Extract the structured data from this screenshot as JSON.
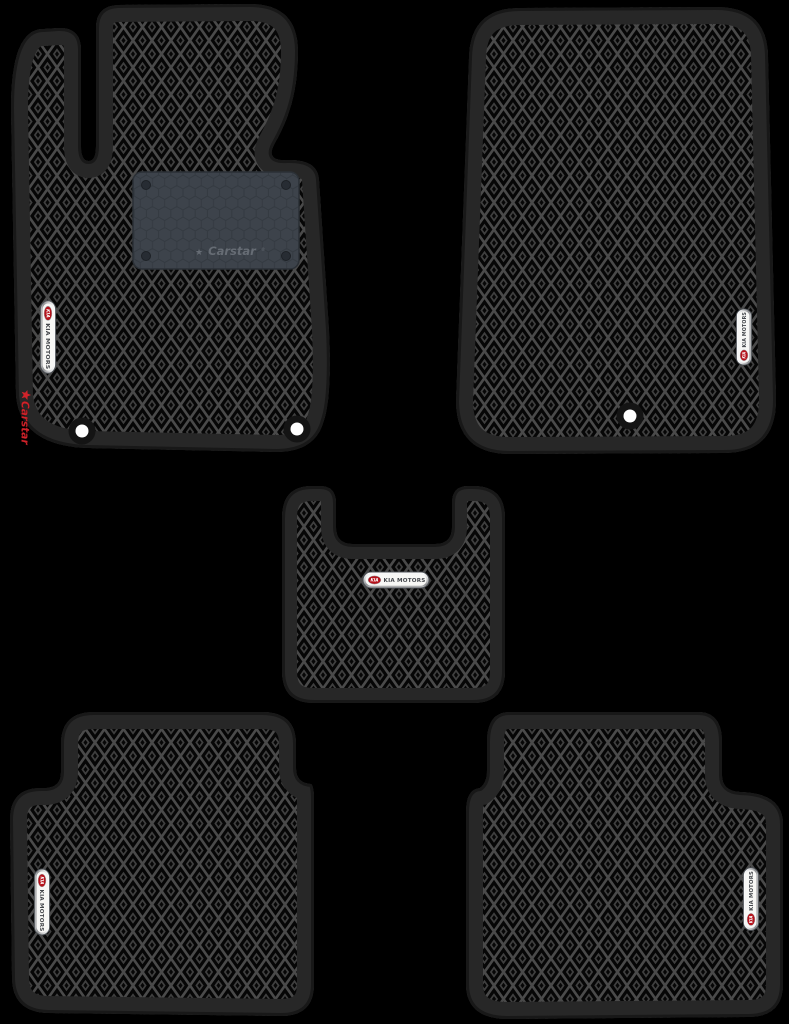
{
  "scene": {
    "background_color": "#000000"
  },
  "colors": {
    "mat_border": "#272727",
    "mat_edge_rim": "#181818",
    "pattern_grid": "#4a4a4a",
    "pattern_cell": "#060606",
    "pattern_ornament": "#3f3f3f",
    "heel_pad_fill": "#3d434b",
    "heel_pad_line": "#343a41",
    "badge_face": "#f7f7f5",
    "kia_red": "#b5121b",
    "badge_text": "#43464b",
    "carstar_red": "#d2232a",
    "heel_text_gray": "#666c74",
    "hole_white": "#ffffff",
    "hole_ring": "#141414"
  },
  "kia_badge": {
    "logo_text": "KIA",
    "label": "KIA MOTORS"
  },
  "carstar": {
    "star": "★",
    "side_label": "Carstar",
    "heel_label": "Carstar",
    "registered": "®"
  },
  "mats": [
    {
      "name": "front-left-driver-mat"
    },
    {
      "name": "front-right-passenger-mat"
    },
    {
      "name": "center-tunnel-mat"
    },
    {
      "name": "rear-left-mat"
    },
    {
      "name": "rear-right-mat"
    }
  ]
}
